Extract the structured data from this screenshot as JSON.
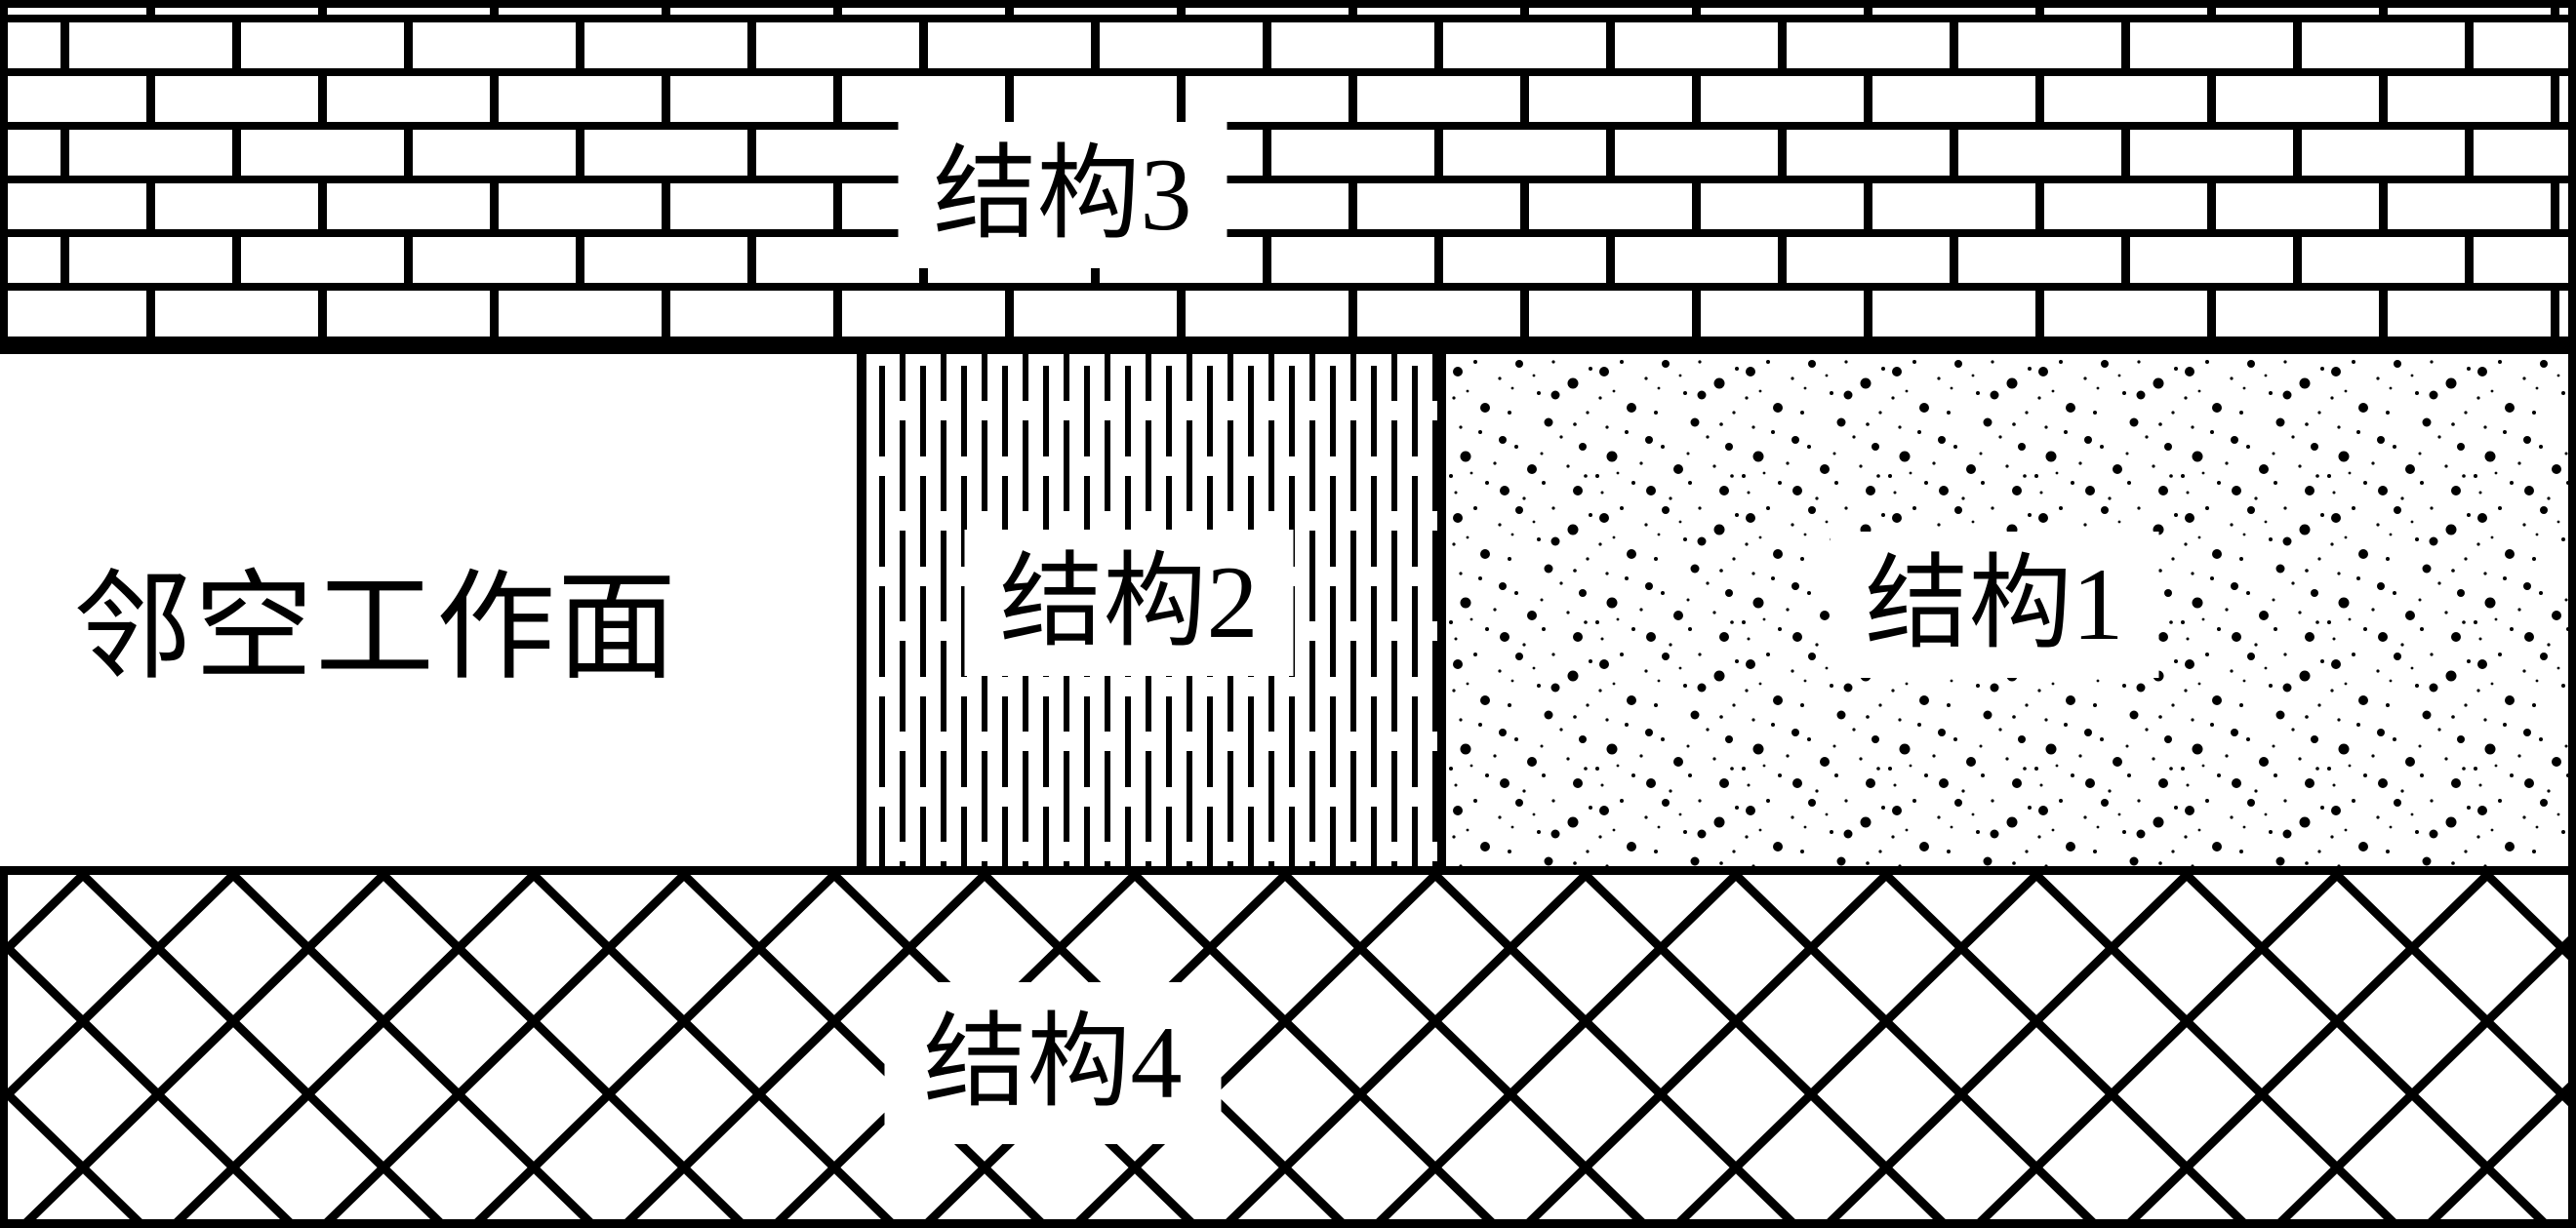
{
  "diagram": {
    "title": "mining-face-structure-schematic",
    "colors": {
      "ink": "#000000",
      "background": "#ffffff"
    },
    "regions": {
      "structure3": {
        "label": "结构3",
        "pattern": "brick-hatch",
        "position": "top-band"
      },
      "workface": {
        "label": "邻空工作面",
        "pattern": "none-white",
        "position": "middle-left"
      },
      "structure2": {
        "label": "结构2",
        "pattern": "vertical-dash-hatch",
        "position": "middle-center"
      },
      "structure1": {
        "label": "结构1",
        "pattern": "stipple-dots",
        "position": "middle-right"
      },
      "structure4": {
        "label": "结构4",
        "pattern": "diamond-crosshatch",
        "position": "bottom-band"
      }
    }
  }
}
